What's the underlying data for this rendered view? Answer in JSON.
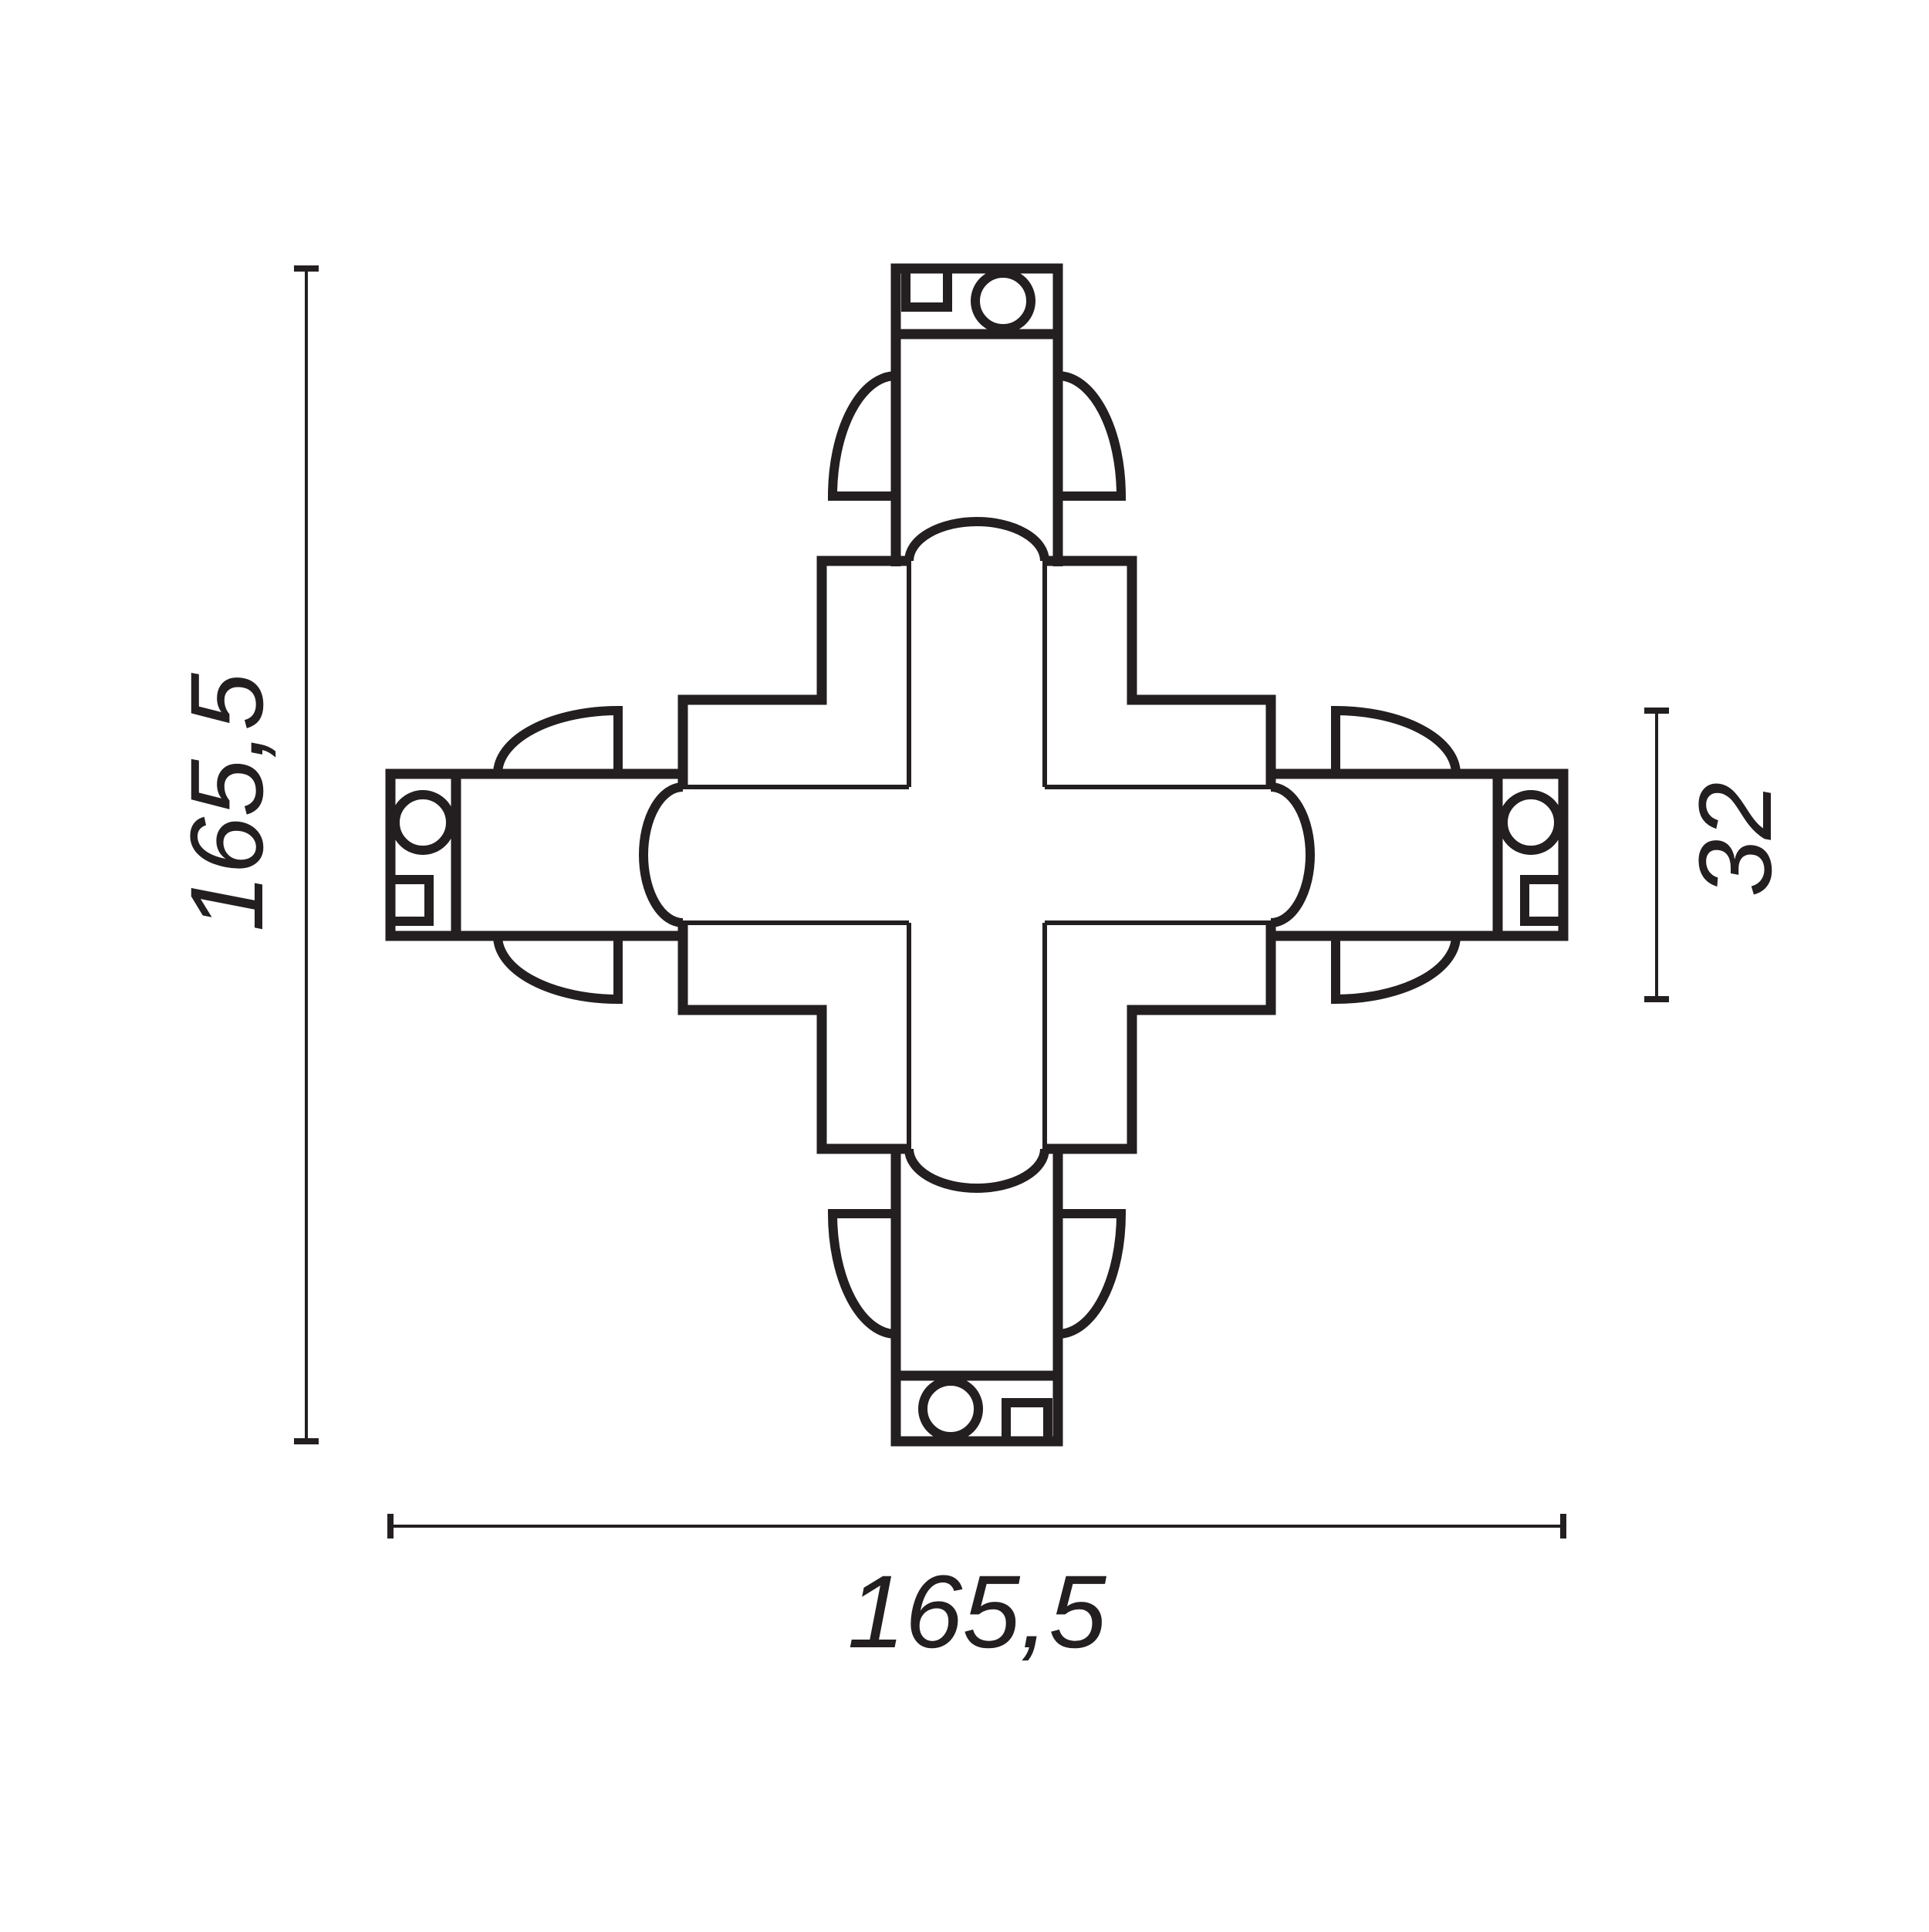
{
  "diagram": {
    "name": "x-connector-dimension-drawing",
    "subject": "4-way X track connector, top view",
    "background": "#ffffff",
    "line_color": "#231f20",
    "labels": {
      "height": "165,5",
      "width": "165,5",
      "depth": "32"
    }
  }
}
